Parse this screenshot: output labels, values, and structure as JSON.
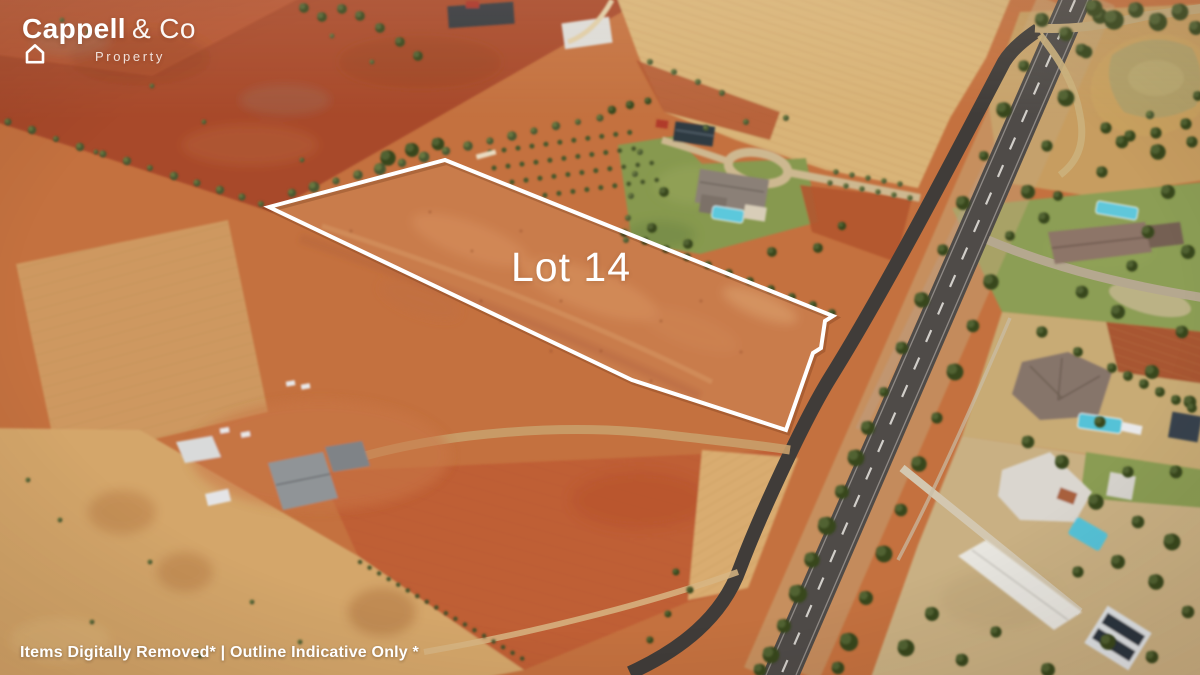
{
  "branding": {
    "wordmark_bold": "Cappell",
    "house_icon": "house-outline-icon",
    "wordmark_suffix": "& Co",
    "subtitle": "Property"
  },
  "lot": {
    "label": "Lot 14"
  },
  "footer": {
    "disclaimer": "Items Digitally Removed* | Outline Indicative Only *"
  },
  "scene": {
    "type": "aerial-drone-photo-rural-land-listing",
    "palette": {
      "soil_base": "#c4713f",
      "soil_red": "#a8492a",
      "soil_lot": "#c97c4c",
      "soil_gold": "#d4a66a",
      "field_pale": "#d9b478",
      "road_asphalt": "#4f4b48",
      "service_road": "#403c39",
      "lawn_green": "#87994f",
      "tree_green": "#37461f",
      "pool_blue": "#5cc8dc",
      "pond_water": "#b3a169",
      "lot_outline": "#ffffff"
    }
  }
}
